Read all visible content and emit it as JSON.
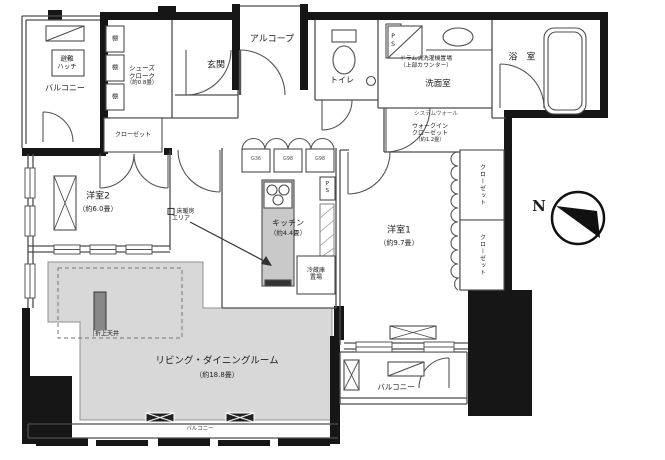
{
  "plan": {
    "compass_label": "N",
    "rooms": {
      "balcony_top_left": {
        "name": "バルコニー"
      },
      "evac_hatch": {
        "line1": "避難",
        "line2": "ハッチ"
      },
      "shoes_cloak": {
        "line1": "シューズ",
        "line2": "クローク",
        "size": "（約0.8畳）"
      },
      "shelf": {
        "label": "棚"
      },
      "hall_closet": {
        "name": "クローゼット"
      },
      "entrance": {
        "name": "玄関"
      },
      "alcove": {
        "name": "アルコープ"
      },
      "toilet": {
        "name": "トイレ"
      },
      "pipe_space_1": {
        "name": "PS"
      },
      "laundry": {
        "line1": "ドラム式洗濯機置場",
        "line2": "（上部カウンター）"
      },
      "washroom": {
        "name": "洗面室"
      },
      "bathroom": {
        "name": "浴　室"
      },
      "system_wall_note": {
        "name": "システムウォール"
      },
      "walk_in_closet": {
        "line1": "ウォークイン",
        "line2": "クローゼット",
        "size": "（約1.2畳）"
      },
      "bedroom2": {
        "name": "洋室2",
        "size": "（約6.0畳）"
      },
      "kitchen": {
        "name": "キッチン",
        "size": "（約4.4畳）"
      },
      "floor_heating": {
        "line1": "床暖房",
        "line2": "エリア"
      },
      "bedroom1": {
        "name": "洋室1",
        "size": "（約9.7畳）"
      },
      "closet_right_1": {
        "name": "クローゼット"
      },
      "closet_right_2": {
        "name": "クローゼット"
      },
      "living_dining": {
        "name": "リビング・ダイニングルーム",
        "size": "（約18.8畳）"
      },
      "raised_ceiling": {
        "name": "折上天井"
      },
      "balcony_bottom_right": {
        "name": "バルコニー"
      },
      "balcony_bottom": {
        "name": "バルコニー"
      },
      "fridge_space": {
        "line1": "冷蔵庫",
        "line2": "置場"
      },
      "cabinets": {
        "c1": "G36",
        "c2": "G98",
        "c3": "G98"
      },
      "pipe_space_2": {
        "name": "PS"
      }
    },
    "colors": {
      "wall": "#161616",
      "line": "#4d4d4d",
      "floor_gray": "#d8d8d8",
      "counter": "#c9c9c9"
    }
  }
}
